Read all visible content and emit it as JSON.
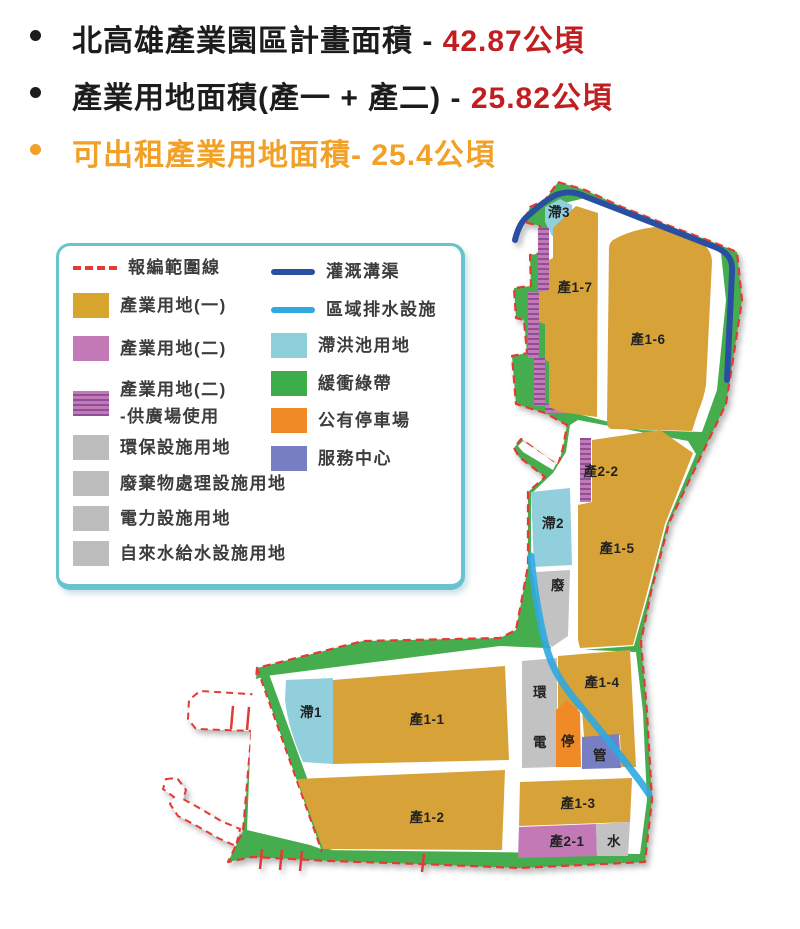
{
  "bullets": [
    {
      "prefix": "北高雄產業園區計畫面積 - ",
      "value": "42.87公頃"
    },
    {
      "prefix": "產業用地面積(產一 + 產二)  - ",
      "value": "25.82公頃"
    },
    {
      "prefix": "可出租產業用地面積- ",
      "value": "25.4公頃"
    }
  ],
  "legend": {
    "col1": [
      {
        "label": "報編範圍線",
        "swatch": "red-dashed-line"
      },
      {
        "label": "產業用地(一)",
        "swatch": "gold"
      },
      {
        "label": "產業用地(二)",
        "swatch": "pink"
      },
      {
        "label": "產業用地(二)",
        "label2": "-供廣場使用",
        "swatch": "pink-striped"
      },
      {
        "label": "環保設施用地",
        "swatch": "gray"
      },
      {
        "label": "廢棄物處理設施用地",
        "swatch": "gray"
      },
      {
        "label": "電力設施用地",
        "swatch": "gray"
      },
      {
        "label": "自來水給水設施用地",
        "swatch": "gray"
      }
    ],
    "col2": [
      {
        "label": "灌溉溝渠",
        "swatch": "navy-line"
      },
      {
        "label": "區域排水設施",
        "swatch": "blue-line"
      },
      {
        "label": "滯洪池用地",
        "swatch": "cyan"
      },
      {
        "label": "緩衝綠帶",
        "swatch": "green"
      },
      {
        "label": "公有停車場",
        "swatch": "orange"
      },
      {
        "label": "服務中心",
        "swatch": "purple"
      }
    ]
  },
  "map": {
    "labels": {
      "z3": "滯3",
      "c17": "產1-7",
      "c16": "產1-6",
      "c22": "產2-2",
      "z2": "滯2",
      "c15": "產1-5",
      "fei": "廢",
      "c14": "產1-4",
      "huan": "環",
      "dian": "電",
      "ting": "停",
      "guan": "管",
      "c13": "產1-3",
      "c21": "產2-1",
      "shui": "水",
      "z1": "滯1",
      "c11": "產1-1",
      "c12": "產1-2"
    }
  },
  "colors": {
    "highlight_red": "#C01E20",
    "highlight_orange": "#F2A126",
    "boundary_dash_red": "#E23B36",
    "industrial_1_gold": "#D7A237",
    "industrial_2_pink": "#C279B6",
    "facility_gray": "#C2C2C2",
    "detention_cyan": "#92CFDC",
    "buffer_green": "#45AD4D",
    "parking_orange": "#F08A26",
    "service_purple": "#777EC2",
    "irrigation_navy": "#2B4FA1",
    "drainage_blue": "#2FA9E1",
    "legend_border_teal": "#67C4CE"
  }
}
